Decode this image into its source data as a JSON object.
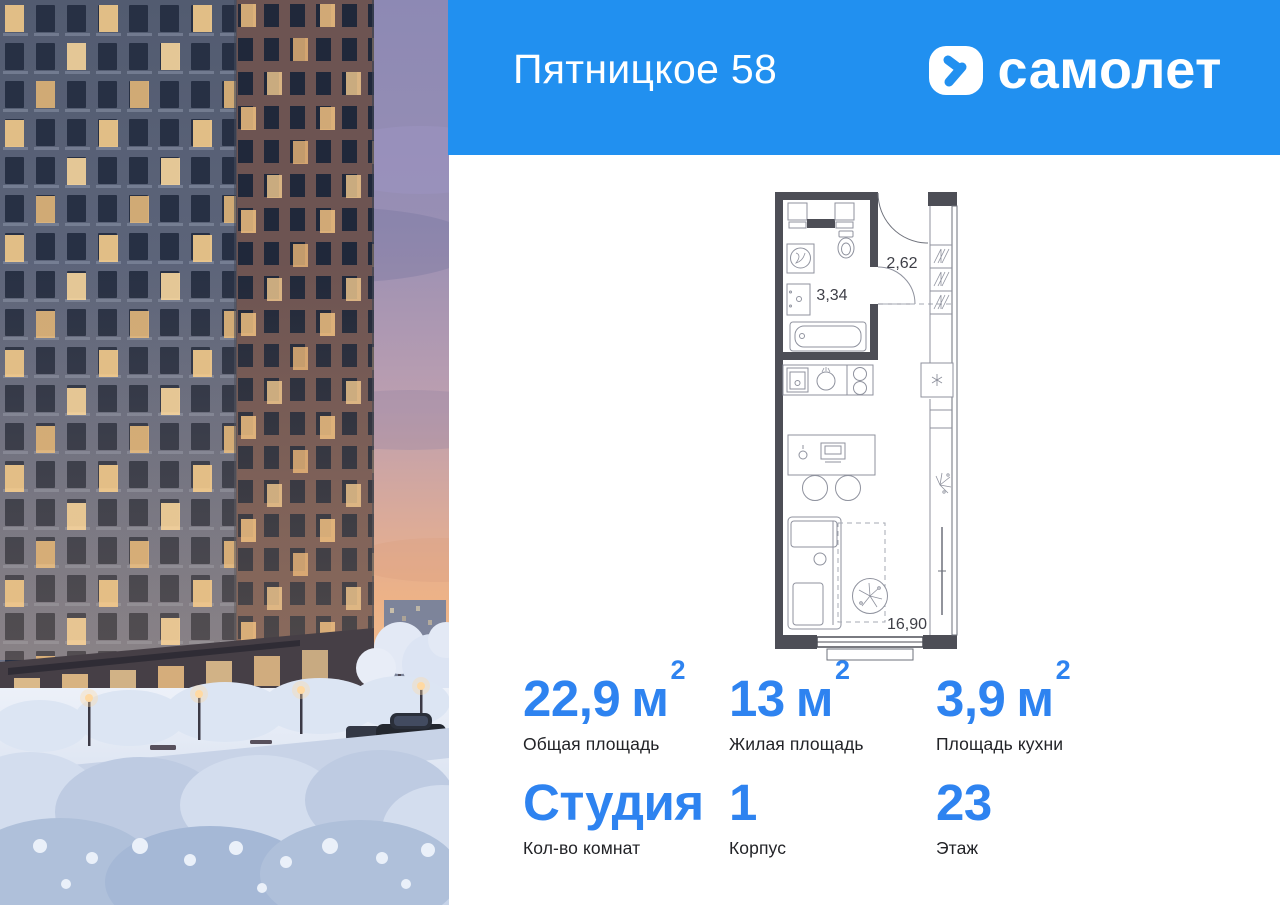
{
  "header": {
    "title": "Пятницкое 58",
    "brand": "самолет"
  },
  "colors": {
    "brand_blue": "#2190F0",
    "stat_blue": "#2E83F0",
    "plan_wall": "#4D4E56"
  },
  "floor_plan": {
    "labels": {
      "bathroom": "3,34",
      "hallway": "2,62",
      "living_room": "16,90"
    }
  },
  "stats": {
    "cells": [
      {
        "value": "22,9",
        "unit": "м",
        "sup": "2",
        "label": "Общая площадь"
      },
      {
        "value": "13",
        "unit": "м",
        "sup": "2",
        "label": "Жилая площадь"
      },
      {
        "value": "3,9",
        "unit": "м",
        "sup": "2",
        "label": "Площадь кухни"
      },
      {
        "value": "Студия",
        "label": "Кол-во комнат"
      },
      {
        "value": "1",
        "label": "Корпус"
      },
      {
        "value": "23",
        "label": "Этаж"
      }
    ]
  }
}
